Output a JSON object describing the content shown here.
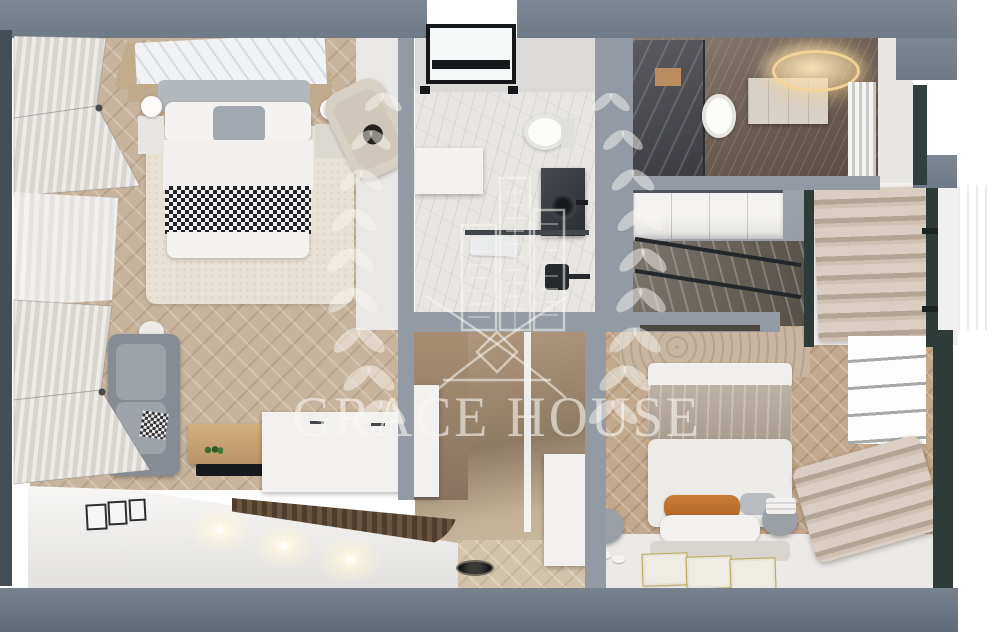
{
  "watermark": {
    "brand_name": "GRACE HOUSE",
    "logo_color": "rgba(250,248,243,0.58)",
    "icons": [
      {
        "name": "laurel-wreath-left-icon",
        "shape": "svg-leaf-ellipses"
      },
      {
        "name": "laurel-wreath-right-icon",
        "shape": "svg-leaf-ellipses"
      },
      {
        "name": "skyline-buildings-icon",
        "shape": "svg-outline-towers"
      },
      {
        "name": "swoosh-cross-icon",
        "shape": "svg-crossing-curves"
      },
      {
        "name": "diamond-icon",
        "shape": "svg-rotated-square"
      },
      {
        "name": "logo-divider-line",
        "shape": "svg-horizontal-rule"
      }
    ]
  },
  "palette": {
    "wall_gray": "#7b8591",
    "wall_gray_dark": "#6f7a86",
    "window_frame_teal": "#2f3b39",
    "left_frame_dark": "#434e56",
    "parquet_wood": "#c8b49c",
    "parquet_wood_warm": "#c2a88c",
    "marble_white": "#e8e6e3",
    "marble_dark": "#6f6057",
    "white_floor": "#ebe9e6",
    "sofa_gray": "#858c93",
    "bed_linen_white": "#f1f0ee",
    "blanket_taupe": "#b0a496",
    "pillow_orange": "#c0742e",
    "warm_vanity_light": "#f2d49c",
    "stair_wood": "#6b553f",
    "checker_dark": "#26262a",
    "skylight_frame_black": "#15171a"
  }
}
